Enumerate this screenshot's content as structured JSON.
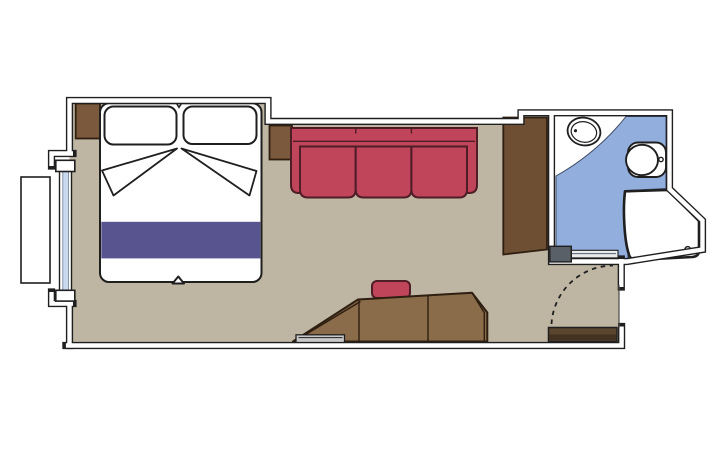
{
  "palette": {
    "background": "#ffffff",
    "wall_fill": "#ffffff",
    "outline": "#1f1f1f",
    "floor": "#beb5a2",
    "bathroom_floor": "#92aedc",
    "bathroom_floor_edge": "#3d4a63",
    "window_glass": "#c9d9ef",
    "window_glass_edge": "#6b7b8f",
    "linen": "#ffffff",
    "wood": "#7b593c",
    "wood_dark": "#6e4f33",
    "wood_desk": "#8a6b4a",
    "wood_outline": "#2e1f10",
    "door_leaf": "#5a452e",
    "door_leaf_dark": "#42321f",
    "upholstery": "#c0445a",
    "upholstery_outline": "#4e1d26",
    "bedding_accent": "#585490",
    "tray": "#c9c9c9",
    "door_track": "#e9ebee",
    "door_handle": "#596067",
    "floor_edge": "#4a4a4a"
  },
  "plan": {
    "rooms": [
      "cabin",
      "bathroom"
    ],
    "furniture": [
      "double-bed",
      "pillow-left",
      "pillow-right",
      "duvet-fold-left",
      "duvet-fold-right",
      "bed-runner",
      "nightstand-left",
      "nightstand-right",
      "sofa",
      "wardrobe",
      "desk-unit",
      "stool",
      "luggage-tray",
      "window",
      "window-exterior-box",
      "washbasin",
      "toilet",
      "shower",
      "bathroom-door",
      "entry-door",
      "entry-door-swing"
    ]
  }
}
